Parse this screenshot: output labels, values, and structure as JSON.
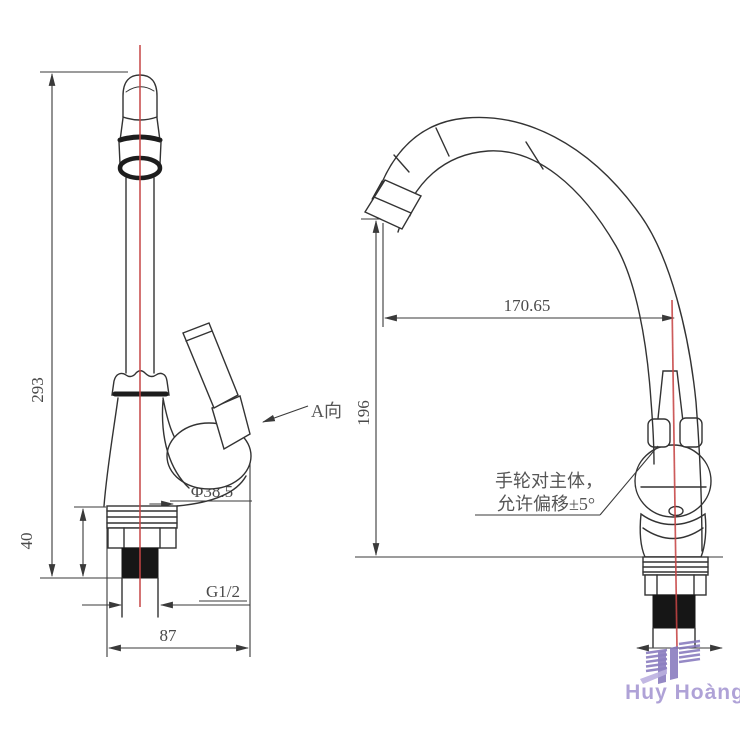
{
  "front_view": {
    "dim_total_height": "293",
    "dim_shank_height": "40",
    "dim_depth": "87",
    "thread_label": "G1/2",
    "base_diameter": "Φ38.5",
    "view_label": "A向"
  },
  "side_view": {
    "dim_reach": "170.65",
    "dim_height": "196",
    "note_line1": "手轮对主体，",
    "note_line2": "允许偏移±5°"
  },
  "watermark": {
    "brand": "Huy Hoàng"
  },
  "colors": {
    "line": "#333333",
    "centerline": "#c64444",
    "dim_text": "#4a4a4a",
    "watermark_text": "#a99bd4",
    "watermark_icon": "#8577bd"
  }
}
